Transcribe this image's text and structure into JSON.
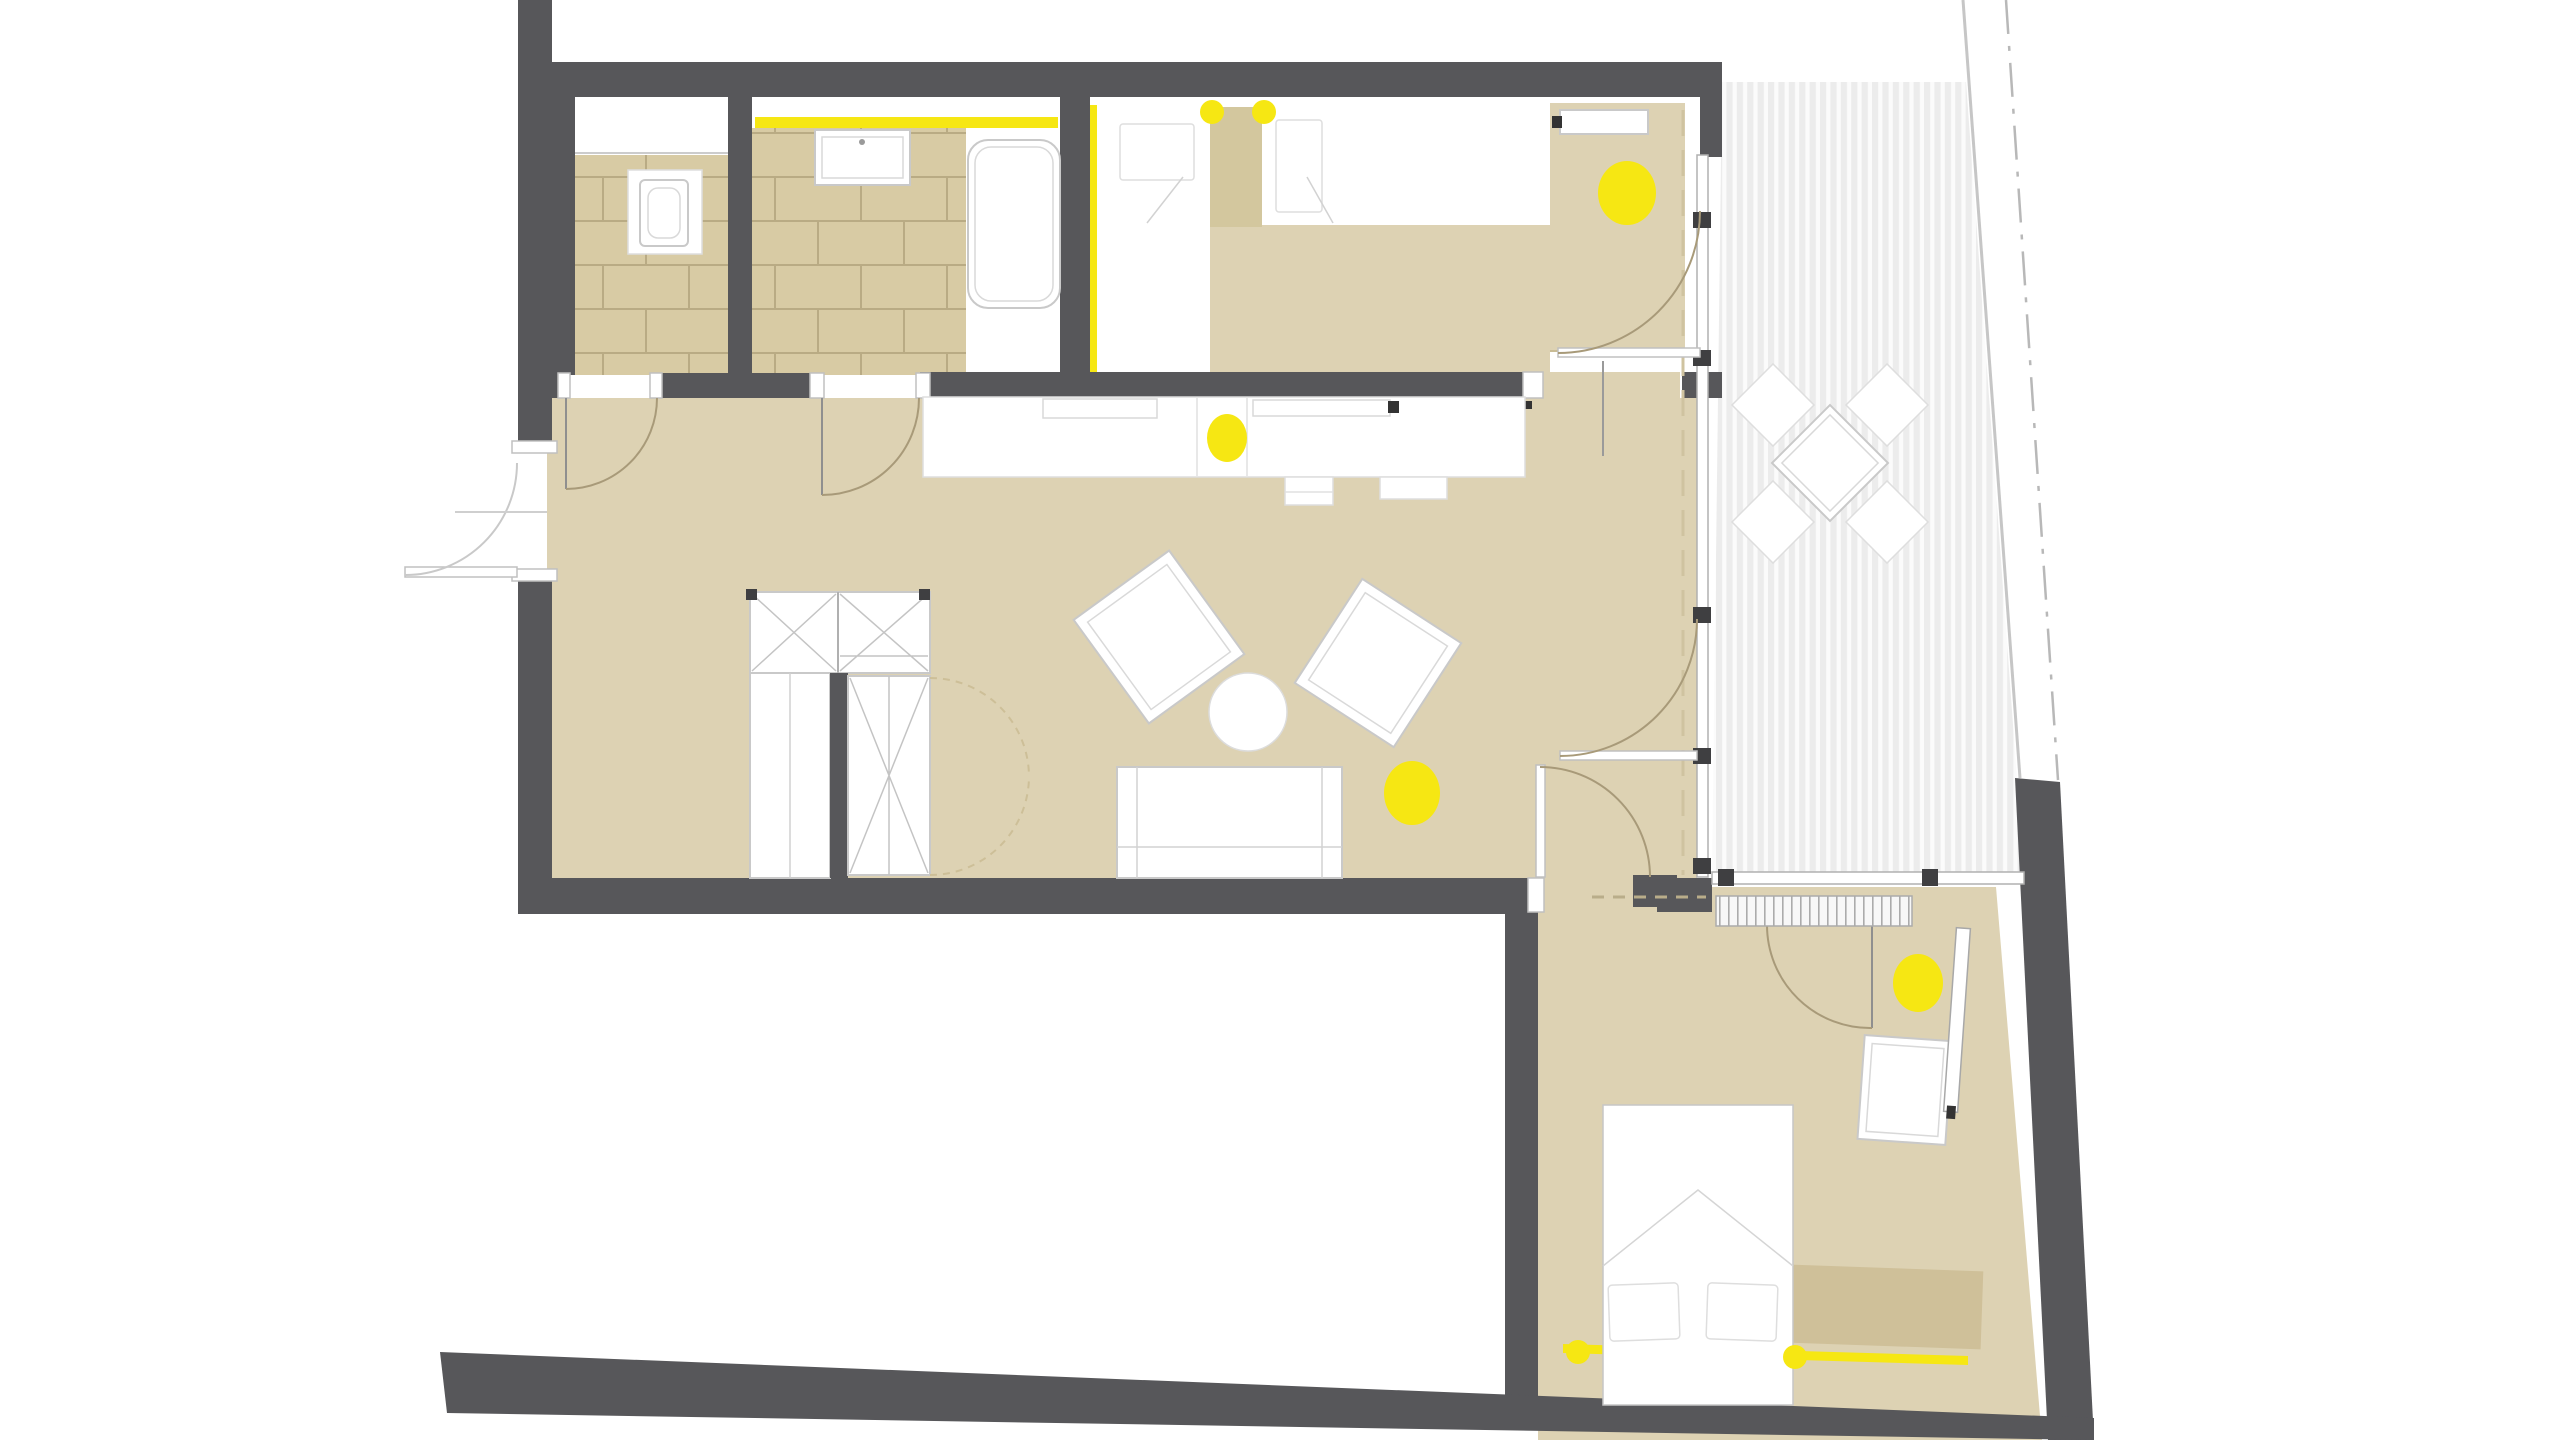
{
  "document": {
    "kind": "architectural-floor-plan",
    "visible_text": [],
    "colors": {
      "wall": "#57575a",
      "wall_dark": "#3f3f41",
      "floor_beige": "#ddd2b3",
      "beige_accent": "#d3c79e",
      "tile": "#d8cba4",
      "tile_grout": "#b9ab84",
      "accent_yellow": "#f6e713",
      "deck_stripe": "#ececec",
      "thin_line": "#c9c9c9",
      "door_arc": "#a89a79",
      "window_line": "#b0b0b0",
      "facade_dash": "#cfc3a0",
      "rug": "#cfc099"
    },
    "rooms": [
      {
        "name": "wc",
        "floor": "tiles",
        "fixtures": [
          "toilet"
        ]
      },
      {
        "name": "bathroom",
        "floor": "tiles",
        "fixtures": [
          "washbasin",
          "bathtub",
          "led-strip"
        ]
      },
      {
        "name": "bedroom-1",
        "floor": "white-beige",
        "fixtures": [
          "double-bed",
          "two-pillows",
          "duvet",
          "built-in-closet",
          "shelf",
          "led-strip"
        ]
      },
      {
        "name": "hall-living-kitchen",
        "floor": "beige",
        "fixtures": [
          "kitchen-counter",
          "sink",
          "stove",
          "x-braced-wardrobe",
          "sofa",
          "two-armchairs",
          "round-side-table"
        ]
      },
      {
        "name": "terrace",
        "floor": "wood-decking",
        "fixtures": [
          "outdoor-table",
          "four-chairs"
        ]
      },
      {
        "name": "bedroom-2",
        "floor": "beige",
        "fixtures": [
          "double-bed",
          "two-pillows",
          "wardrobe",
          "desk",
          "radiator",
          "rug",
          "led-strip"
        ]
      }
    ],
    "lights": [
      {
        "id": "light-bedroom1-closet",
        "x": 1627,
        "y": 193,
        "rx": 29,
        "ry": 32
      },
      {
        "id": "light-kitchen-counter",
        "x": 1227,
        "y": 438,
        "rx": 20,
        "ry": 24
      },
      {
        "id": "light-living",
        "x": 1412,
        "y": 793,
        "rx": 28,
        "ry": 32
      },
      {
        "id": "light-bedroom2",
        "x": 1918,
        "y": 983,
        "rx": 25,
        "ry": 29
      },
      {
        "id": "light-bed1-left",
        "x": 1212,
        "y": 112,
        "rx": 12,
        "ry": 12
      },
      {
        "id": "light-bed1-right",
        "x": 1264,
        "y": 112,
        "rx": 12,
        "ry": 12
      },
      {
        "id": "light-bedroom2-strip-a",
        "x": 1578,
        "y": 1352,
        "rx": 12,
        "ry": 12
      },
      {
        "id": "light-bedroom2-strip-b",
        "x": 1795,
        "y": 1357,
        "rx": 12,
        "ry": 12
      }
    ],
    "led_strips": [
      {
        "id": "strip-bathroom",
        "points": "755,117 1058,117 1058,128 755,128"
      },
      {
        "id": "strip-bedroom1-wall",
        "points": "1088,105 1097,105 1097,372 1088,372"
      },
      {
        "id": "strip-bedroom2-bottom",
        "points": "1563,1344 1968,1356 1968,1365 1563,1353"
      }
    ]
  }
}
